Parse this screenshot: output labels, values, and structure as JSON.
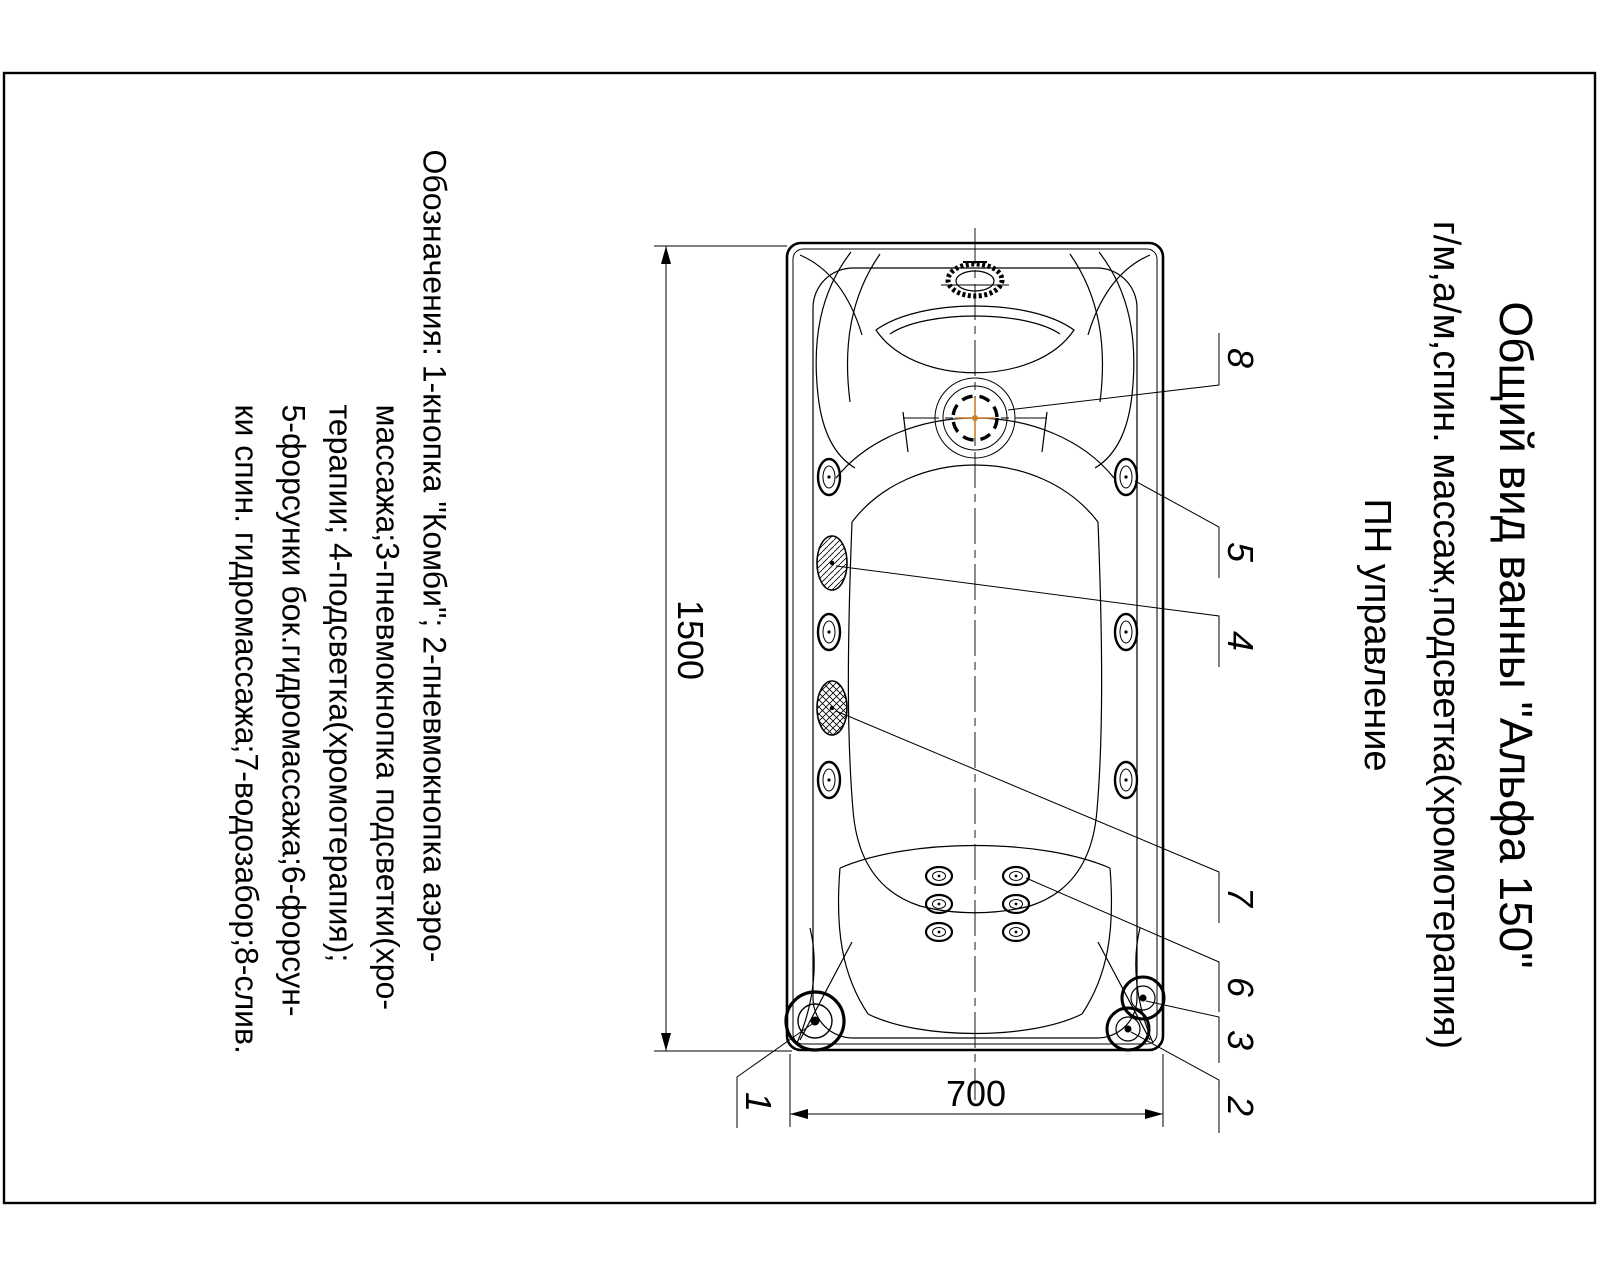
{
  "title_block": {
    "line1": "Общий вид ванны \"Альфа 150\"",
    "line2": "г/м,а/м,спин. массаж,подсветка(хромотерапия)",
    "line3": "ПН управление"
  },
  "legend": {
    "lines": [
      "Обозначения: 1-кнопка \"Комби\"; 2-пневмокнопка аэро-",
      "массажа;3-пневмокнопка подсветки(хро-",
      "терапии; 4-подсветка(хромотерапия);",
      "5-форсунки бок.гидромассажа;6-форсун-",
      "ки спин. гидромассажа;7-водозабор;8-слив."
    ]
  },
  "drawing": {
    "dim_length": "1500",
    "dim_width": "700",
    "callouts": {
      "c1": "1",
      "c2": "2",
      "c3": "3",
      "c4": "4",
      "c5": "5",
      "c6": "6",
      "c7": "7",
      "c8": "8"
    }
  },
  "colors": {
    "ink": "#000000",
    "accent": "#c8842c"
  }
}
